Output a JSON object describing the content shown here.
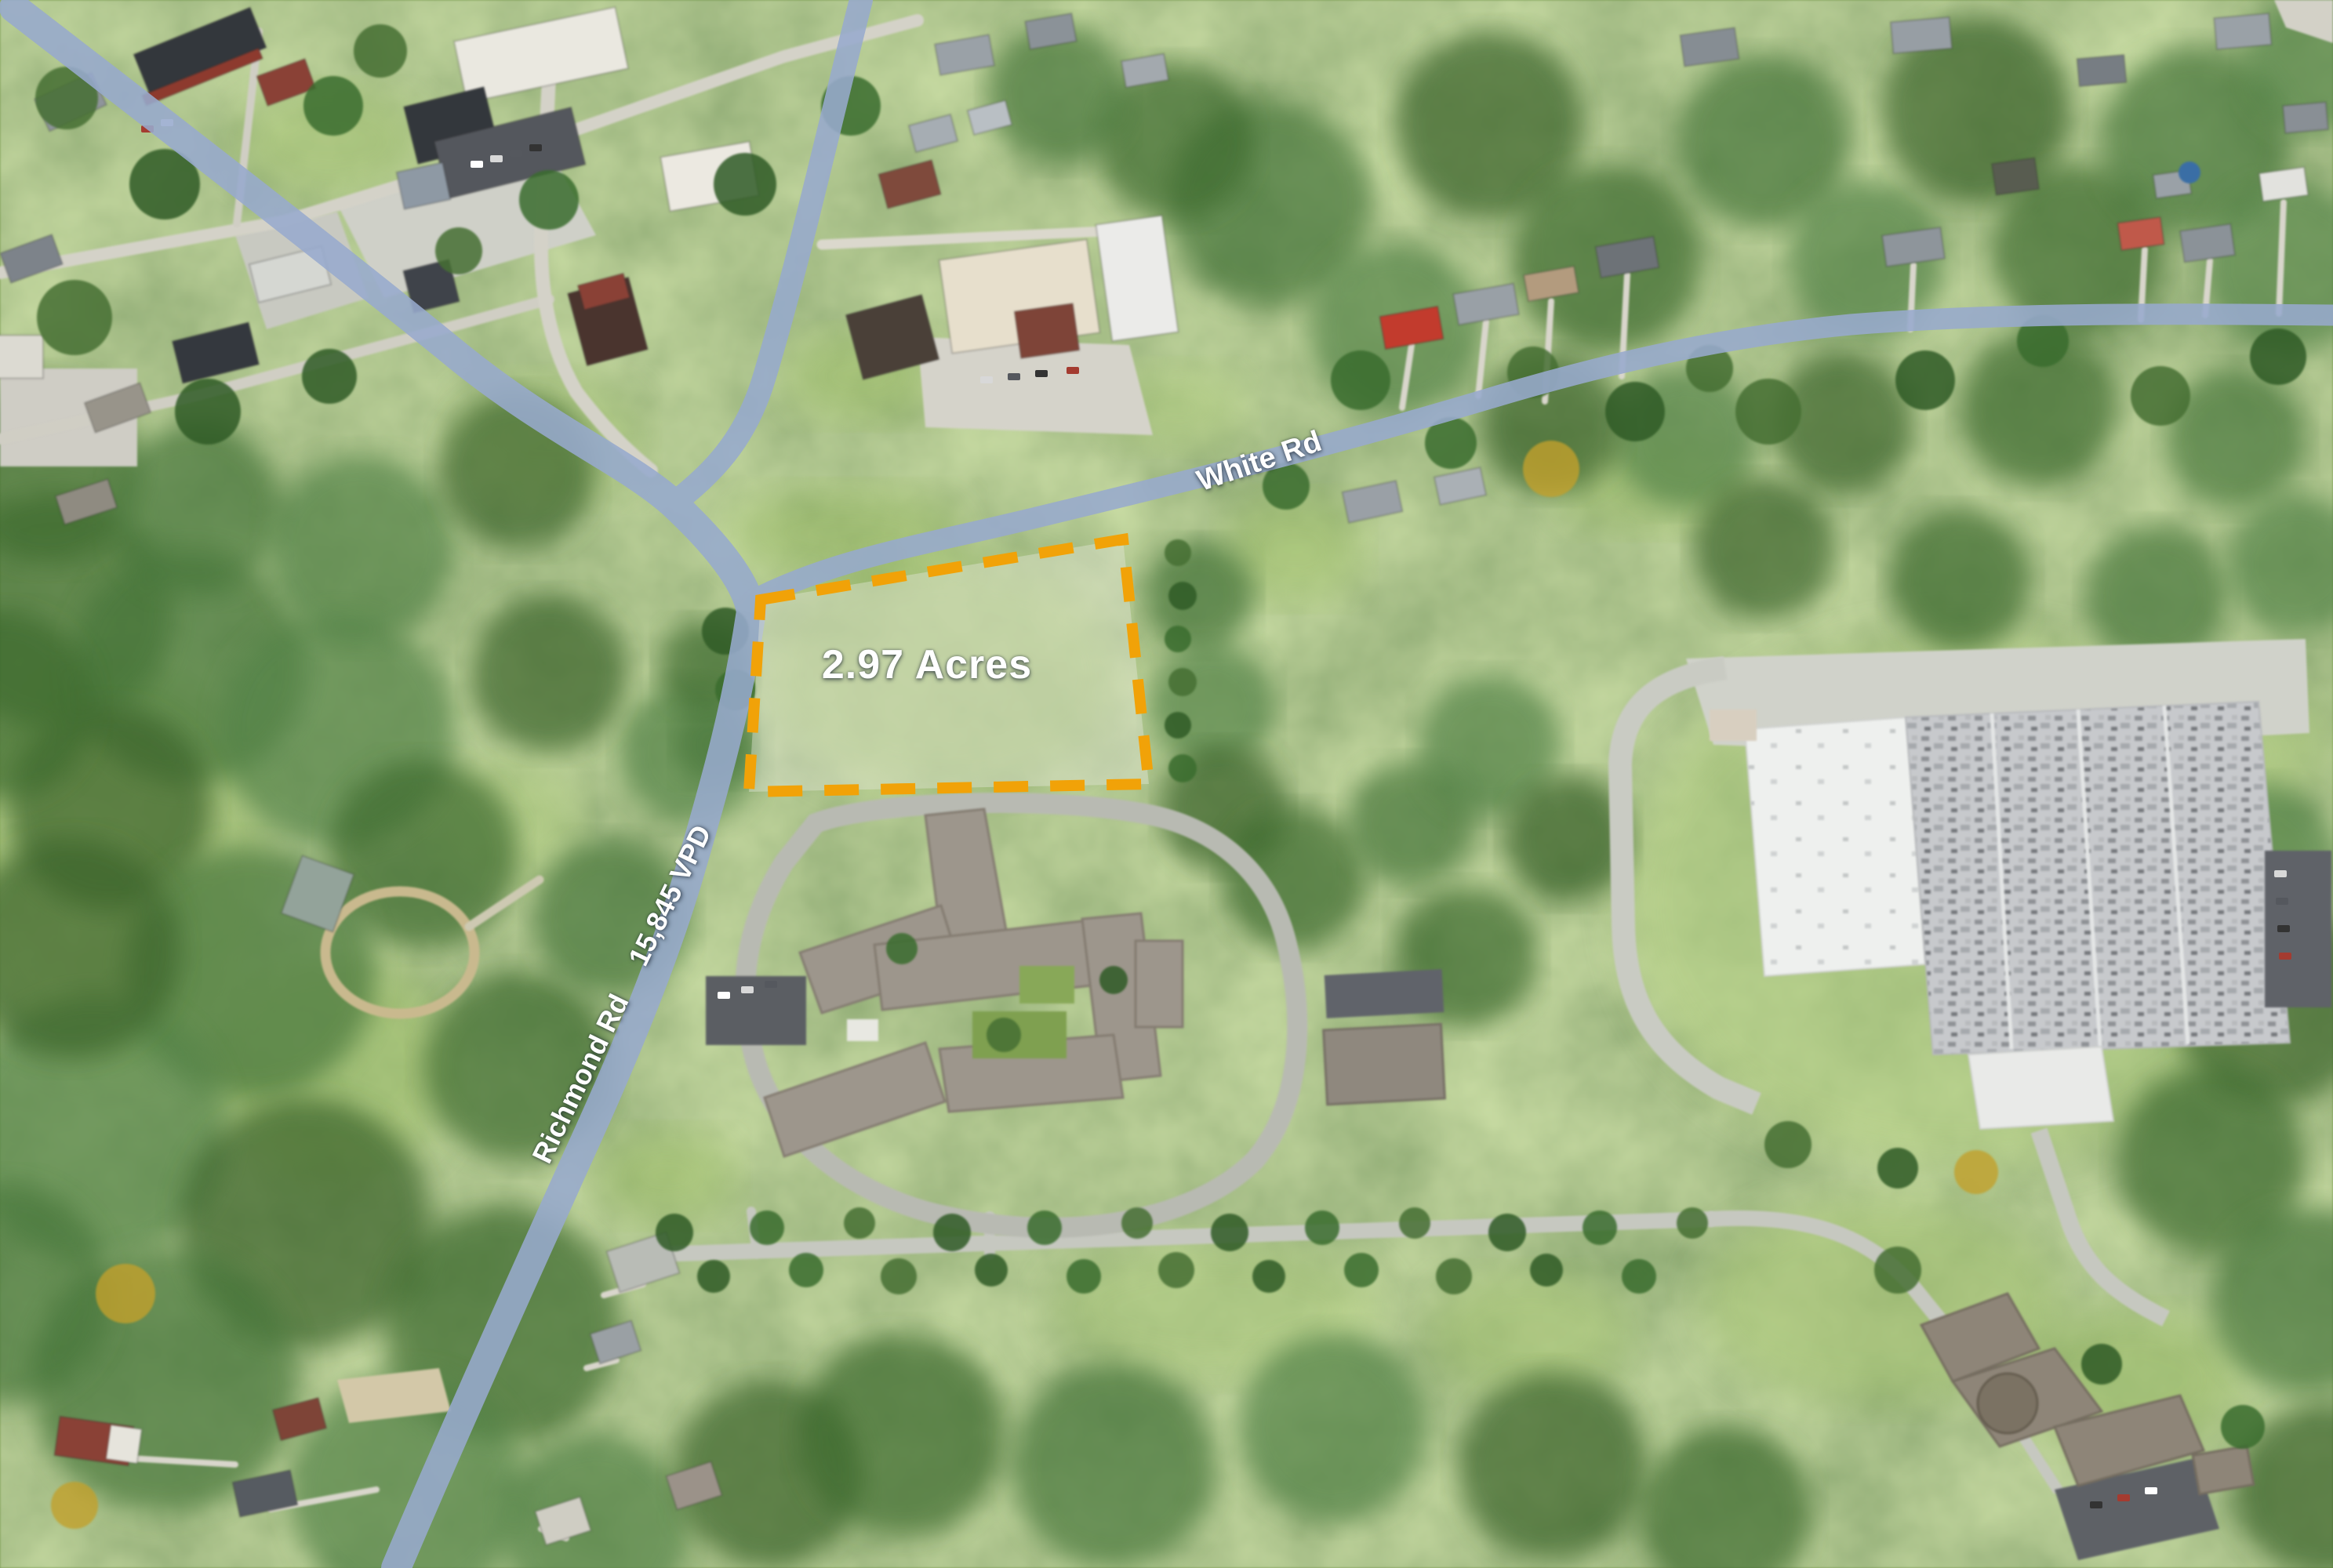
{
  "annotations": {
    "parcel": {
      "acreage_label": "2.97 Acres",
      "outline_color": "#F1A208",
      "fill_color": "rgba(228,230,218,0.42)"
    },
    "roads": {
      "white_rd": {
        "label": "White Rd"
      },
      "richmond_rd": {
        "label": "Richmond Rd",
        "traffic_count": "15,845 VPD"
      }
    },
    "road_highlight_color": "#97AACD"
  }
}
